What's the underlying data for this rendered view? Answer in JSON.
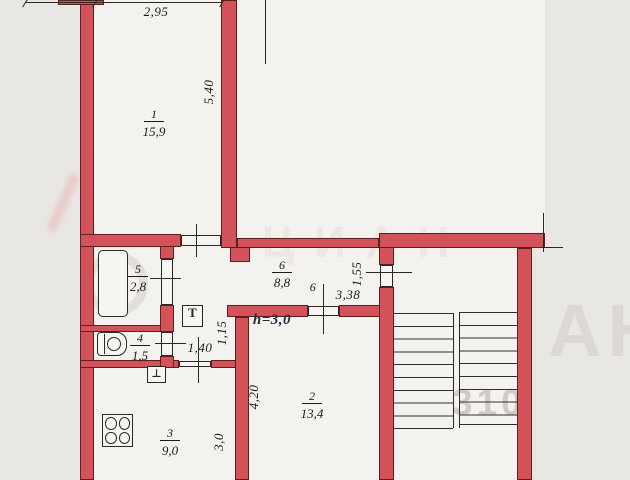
{
  "plan": {
    "rooms": [
      {
        "number": "1",
        "area": "15,9"
      },
      {
        "number": "2",
        "area": "13,4"
      },
      {
        "number": "3",
        "area": "9,0"
      },
      {
        "number": "4",
        "area": "1,5"
      },
      {
        "number": "5",
        "area": "2,8"
      },
      {
        "number": "6",
        "area": "8,8"
      }
    ],
    "dims": {
      "room1_width": "2,95",
      "room1_depth": "5,40",
      "entry": "1,55",
      "room2_width": "3,38",
      "hall": "1,15",
      "kitchen_door": "1,40",
      "room2_depth": "4,20",
      "kitchen_width": "3,0"
    },
    "height_note": "h=3,0",
    "door_mark": "6",
    "fixtures": {
      "heater": "Т",
      "sink": "⊥"
    },
    "watermark": {
      "brand": "ЦИАН",
      "number": "310",
      "edge": "АН"
    },
    "colors": {
      "wall": "#d4535b",
      "line": "#2b2722",
      "paper": "#f4f2ee",
      "outside": "#e9e7e3"
    }
  }
}
